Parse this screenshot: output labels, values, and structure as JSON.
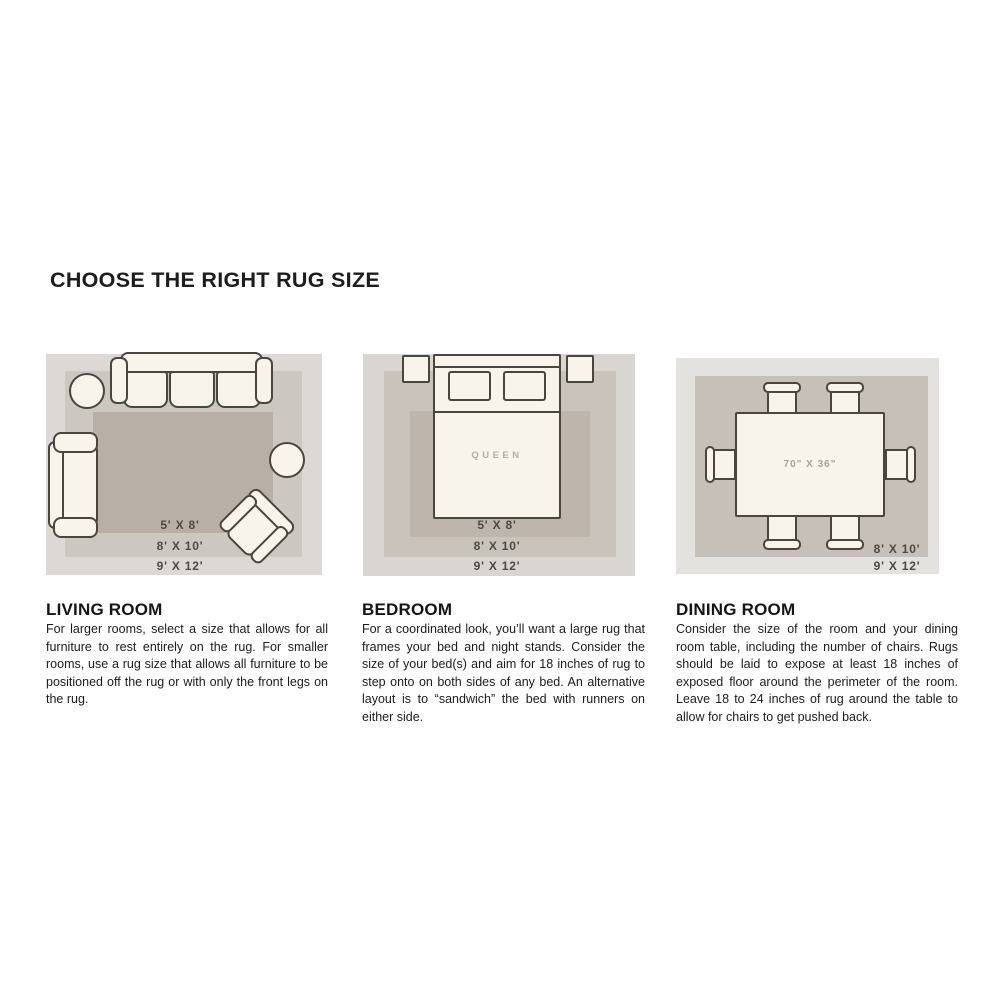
{
  "page": {
    "title": "CHOOSE THE RIGHT RUG SIZE",
    "background": "#ffffff"
  },
  "colors": {
    "furniture_fill": "#f8f4eb",
    "furniture_outline": "#4a463e",
    "rug_light": "#dcd9d5",
    "rug_medium": "#ccc7c0",
    "rug_dark": "#b8b0a7",
    "label_text": "#4d4a44",
    "heading_text": "#151515",
    "body_text": "#1b1b1b"
  },
  "sections": [
    {
      "id": "living-room",
      "heading": "LIVING ROOM",
      "description": "For larger rooms, select a size that allows for all furniture to rest entirely on the rug. For smaller rooms, use a rug size that allows all furniture to be positioned off the rug or with only the front legs on the rug.",
      "rug_sizes": [
        "5' X 8'",
        "8' X 10'",
        "9' X 12'"
      ],
      "furniture": [
        "sofa",
        "loveseat",
        "armchair",
        "round-side-table",
        "round-side-table"
      ]
    },
    {
      "id": "bedroom",
      "heading": "BEDROOM",
      "description": "For a coordinated look, you’ll want a large rug that frames your bed and night stands. Consider the size of your bed(s) and aim for 18 inches of rug to step onto on both sides of any bed. An alternative layout is to “sandwich” the bed with runners on either side.",
      "rug_sizes": [
        "5' X 8'",
        "8' X 10'",
        "9' X 12'"
      ],
      "bed_label": "QUEEN",
      "furniture": [
        "queen-bed",
        "nightstand",
        "nightstand"
      ]
    },
    {
      "id": "dining-room",
      "heading": "DINING ROOM",
      "description": "Consider the size of the room and your dining room table, including the number of chairs. Rugs should be laid to expose at least 18 inches of exposed floor around the perimeter of the room. Leave 18 to 24 inches of rug around the table to allow for chairs to get pushed back.",
      "rug_sizes": [
        "8' X 10'",
        "9' X 12'"
      ],
      "table_label": "70\" X 36\"",
      "furniture": [
        "dining-table",
        "chair",
        "chair",
        "chair",
        "chair",
        "chair",
        "chair"
      ]
    }
  ]
}
